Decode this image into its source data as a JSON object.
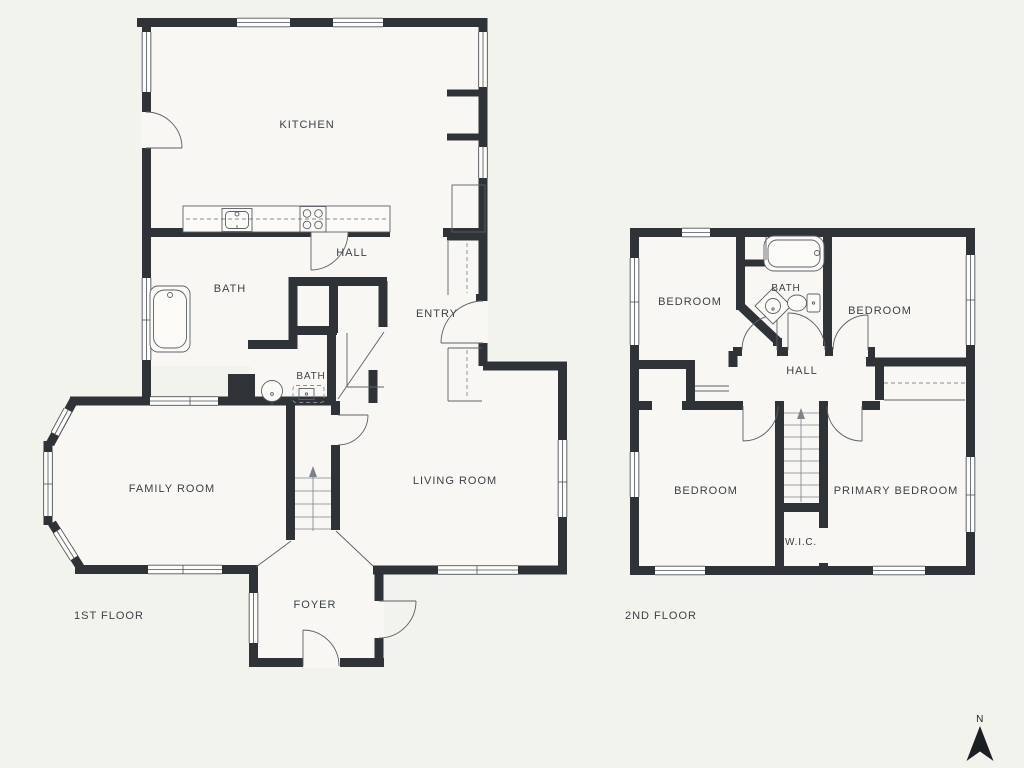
{
  "colors": {
    "background": "#f3f3ee",
    "floor": "#f8f7f3",
    "wall": "#2f3338",
    "line": "#5b6067",
    "text": "#3c4147"
  },
  "floor1": {
    "label": "1ST FLOOR",
    "rooms": {
      "kitchen": "KITCHEN",
      "hall": "HALL",
      "bath": "BATH",
      "bath_small": "BATH",
      "entry": "ENTRY",
      "family_room": "FAMILY ROOM",
      "living_room": "LIVING ROOM",
      "foyer": "FOYER"
    }
  },
  "floor2": {
    "label": "2ND FLOOR",
    "rooms": {
      "bedroom_top_left": "BEDROOM",
      "bath": "BATH",
      "bedroom_top_right": "BEDROOM",
      "hall": "HALL",
      "bedroom_bottom_left": "BEDROOM",
      "primary_bedroom": "PRIMARY BEDROOM",
      "walk_in_closet": "W.I.C."
    }
  },
  "compass": {
    "north": "N"
  }
}
